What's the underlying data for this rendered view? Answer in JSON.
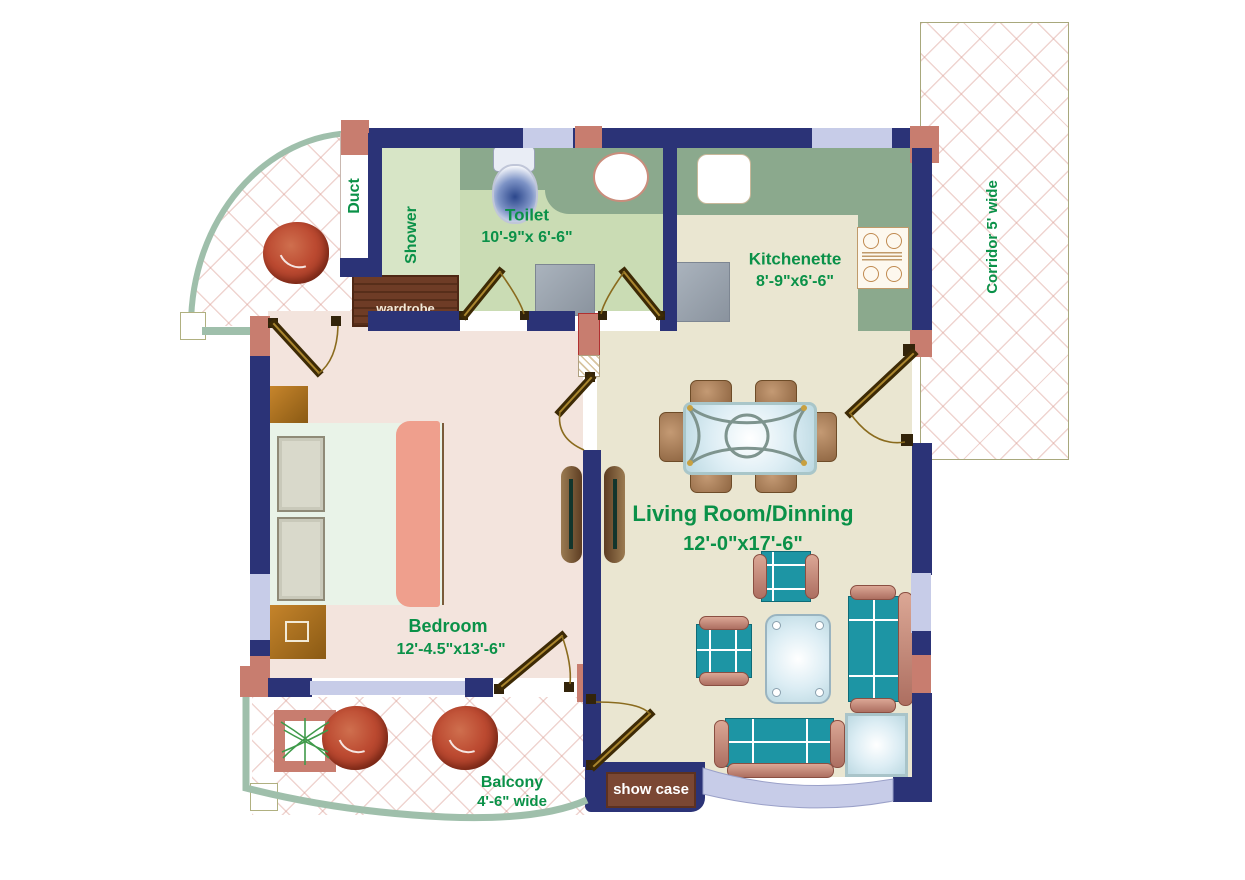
{
  "title": "Apartment unit floor plan",
  "colors": {
    "wall_navy": "#2b3377",
    "pillar_salmon": "#c87d6f",
    "window_lavender": "#c7cce8",
    "label_green": "#0a9148",
    "floor_living": "#eae6d1",
    "floor_bedroom": "#f3e4dd",
    "floor_toilet": "#cadcb4",
    "counter_green": "#8ba98d",
    "furniture_teal": "#1d95a4",
    "red_chair": "#b33f28",
    "railing_sage": "#9fbfab",
    "door_wood": "#3d2a05"
  },
  "rooms": {
    "toilet": {
      "name": "Toilet",
      "dims": "10'-9\"x 6'-6\""
    },
    "kitchenette": {
      "name": "Kitchenette",
      "dims": "8'-9\"x6'-6\""
    },
    "living": {
      "name": "Living Room/Dinning",
      "dims": "12'-0\"x17'-6\""
    },
    "bedroom": {
      "name": "Bedroom",
      "dims": "12'-4.5\"x13'-6\""
    },
    "balcony": {
      "name": "Balcony",
      "dims": "4'-6\" wide"
    },
    "corridor": {
      "label": "Corridor 5' wide"
    }
  },
  "areas": {
    "duct": "Duct",
    "shower": "Shower"
  },
  "fixtures": {
    "wardrobe": "wardrobe",
    "showcase": "show case"
  }
}
